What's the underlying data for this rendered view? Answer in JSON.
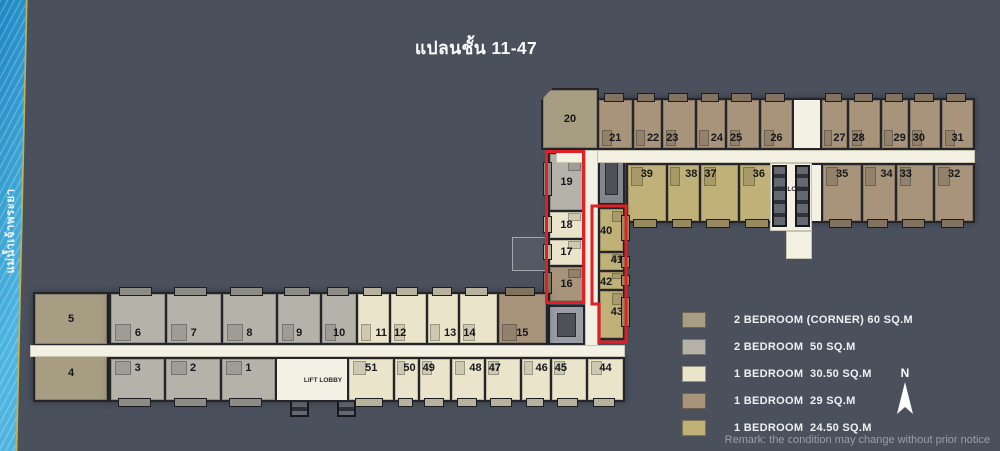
{
  "title": "แปลนชั้น 11-47",
  "river_label": "แม่น้ำเจ้าพระยา",
  "remark": "Remark: the condition may change without prior notice",
  "north_label": "N",
  "lift_lobby_label": "LIFT LOBBY",
  "highlight_color": "#e11f25",
  "colors": {
    "background": "#4a515d",
    "corridor": "#f3f0e4",
    "wall": "#23252b",
    "river_water": "#2f9ed2",
    "river_bank": "#c2b24e"
  },
  "legend": {
    "items": [
      {
        "label": "2 BEDROOM (CORNER) 60 SQ.M",
        "color": "#a79d82",
        "type": "corner60"
      },
      {
        "label": "2 BEDROOM  50 SQ.M",
        "color": "#b5b2aa",
        "type": "2br50"
      },
      {
        "label": "1 BEDROOM  30.50 SQ.M",
        "color": "#e9e4ca",
        "type": "1br305"
      },
      {
        "label": "1 BEDROOM  29 SQ.M",
        "color": "#a7947b",
        "type": "1br29"
      },
      {
        "label": "1 BEDROOM  24.50 SQ.M",
        "color": "#c0b178",
        "type": "1br245"
      }
    ]
  },
  "top_wing": {
    "row_upper": [
      {
        "no": "21",
        "t": "1br29",
        "w": 38,
        "a": "c"
      },
      {
        "no": "22",
        "t": "1br29",
        "w": 30,
        "a": "r"
      },
      {
        "no": "23",
        "t": "1br29",
        "w": 34,
        "a": "l"
      },
      {
        "no": "24",
        "t": "1br29",
        "w": 30,
        "a": "r"
      },
      {
        "no": "25",
        "t": "1br29",
        "w": 34,
        "a": "l"
      },
      {
        "no": "26",
        "t": "1br29",
        "w": 36,
        "a": "c"
      },
      {
        "no": "",
        "t": "hall",
        "w": 30,
        "a": "c"
      },
      {
        "no": "27",
        "t": "1br29",
        "w": 28,
        "a": "r"
      },
      {
        "no": "28",
        "t": "1br29",
        "w": 32,
        "a": "l"
      },
      {
        "no": "29",
        "t": "1br29",
        "w": 28,
        "a": "r"
      },
      {
        "no": "30",
        "t": "1br29",
        "w": 32,
        "a": "l"
      },
      {
        "no": "31",
        "t": "1br29",
        "w": 36,
        "a": "c"
      }
    ],
    "row_lower": [
      {
        "no": "39",
        "t": "1br245",
        "w": 38,
        "a": "c"
      },
      {
        "no": "38",
        "t": "1br245",
        "w": 30,
        "a": "r"
      },
      {
        "no": "37",
        "t": "1br245",
        "w": 34,
        "a": "l"
      },
      {
        "no": "36",
        "t": "1br245",
        "w": 38,
        "a": "c"
      },
      {
        "no": "",
        "t": "hall",
        "w": 42,
        "a": "c"
      },
      {
        "no": "35",
        "t": "1br29",
        "w": 38,
        "a": "c"
      },
      {
        "no": "34",
        "t": "1br29",
        "w": 30,
        "a": "r"
      },
      {
        "no": "33",
        "t": "1br29",
        "w": 34,
        "a": "l"
      },
      {
        "no": "32",
        "t": "1br29",
        "w": 38,
        "a": "c"
      }
    ]
  },
  "mid_section": {
    "unit20": {
      "no": "20"
    },
    "col_left": [
      {
        "no": "19",
        "t": "2br50",
        "w": 60,
        "a": "c"
      },
      {
        "no": "18",
        "t": "1br305",
        "w": 28,
        "a": "c"
      },
      {
        "no": "17",
        "t": "1br305",
        "w": 27,
        "a": "c"
      },
      {
        "no": "16",
        "t": "1br29",
        "w": 36,
        "a": "c"
      }
    ],
    "col_right": [
      {
        "no": "40",
        "t": "1br245",
        "w": 47,
        "a": "c",
        "va": "t"
      },
      {
        "no": "41",
        "t": "1br245",
        "w": 17,
        "a": "c",
        "va": "b"
      },
      {
        "no": "42",
        "t": "1br245",
        "w": 16,
        "a": "c",
        "va": "t"
      },
      {
        "no": "43",
        "t": "1br245",
        "w": 53,
        "a": "c",
        "va": "b"
      }
    ]
  },
  "bottom_wing": {
    "corner": [
      {
        "no": "5",
        "t": "corner60",
        "w": 53,
        "a": "c"
      },
      {
        "no": "4",
        "t": "corner60",
        "w": 57,
        "a": "c"
      }
    ],
    "row_upper": [
      {
        "no": "6",
        "t": "2br50",
        "w": 58,
        "a": "c"
      },
      {
        "no": "7",
        "t": "2br50",
        "w": 58,
        "a": "c"
      },
      {
        "no": "8",
        "t": "2br50",
        "w": 58,
        "a": "c"
      },
      {
        "no": "9",
        "t": "2br50",
        "w": 45,
        "a": "c"
      },
      {
        "no": "10",
        "t": "2br50",
        "w": 37,
        "a": "c"
      },
      {
        "no": "11",
        "t": "1br305",
        "w": 31,
        "a": "r"
      },
      {
        "no": "12",
        "t": "1br305",
        "w": 34,
        "a": "l"
      },
      {
        "no": "13",
        "t": "1br305",
        "w": 31,
        "a": "r"
      },
      {
        "no": "14",
        "t": "1br305",
        "w": 36,
        "a": "l"
      },
      {
        "no": "15",
        "t": "1br29",
        "w": 51,
        "a": "c"
      }
    ],
    "row_lower": [
      {
        "no": "3",
        "t": "2br50",
        "w": 58,
        "a": "c"
      },
      {
        "no": "2",
        "t": "2br50",
        "w": 58,
        "a": "c"
      },
      {
        "no": "1",
        "t": "2br50",
        "w": 58,
        "a": "c"
      },
      {
        "no": "",
        "t": "hall",
        "w": 76,
        "a": "c"
      },
      {
        "no": "51",
        "t": "1br305",
        "w": 48,
        "a": "c"
      },
      {
        "no": "50",
        "t": "1br305",
        "w": 22,
        "a": "r"
      },
      {
        "no": "49",
        "t": "1br305",
        "w": 30,
        "a": "l"
      },
      {
        "no": "48",
        "t": "1br305",
        "w": 32,
        "a": "r"
      },
      {
        "no": "47",
        "t": "1br305",
        "w": 34,
        "a": "l"
      },
      {
        "no": "46",
        "t": "1br305",
        "w": 28,
        "a": "r"
      },
      {
        "no": "45",
        "t": "1br305",
        "w": 34,
        "a": "l"
      },
      {
        "no": "44",
        "t": "1br305",
        "w": 38,
        "a": "c"
      }
    ]
  }
}
